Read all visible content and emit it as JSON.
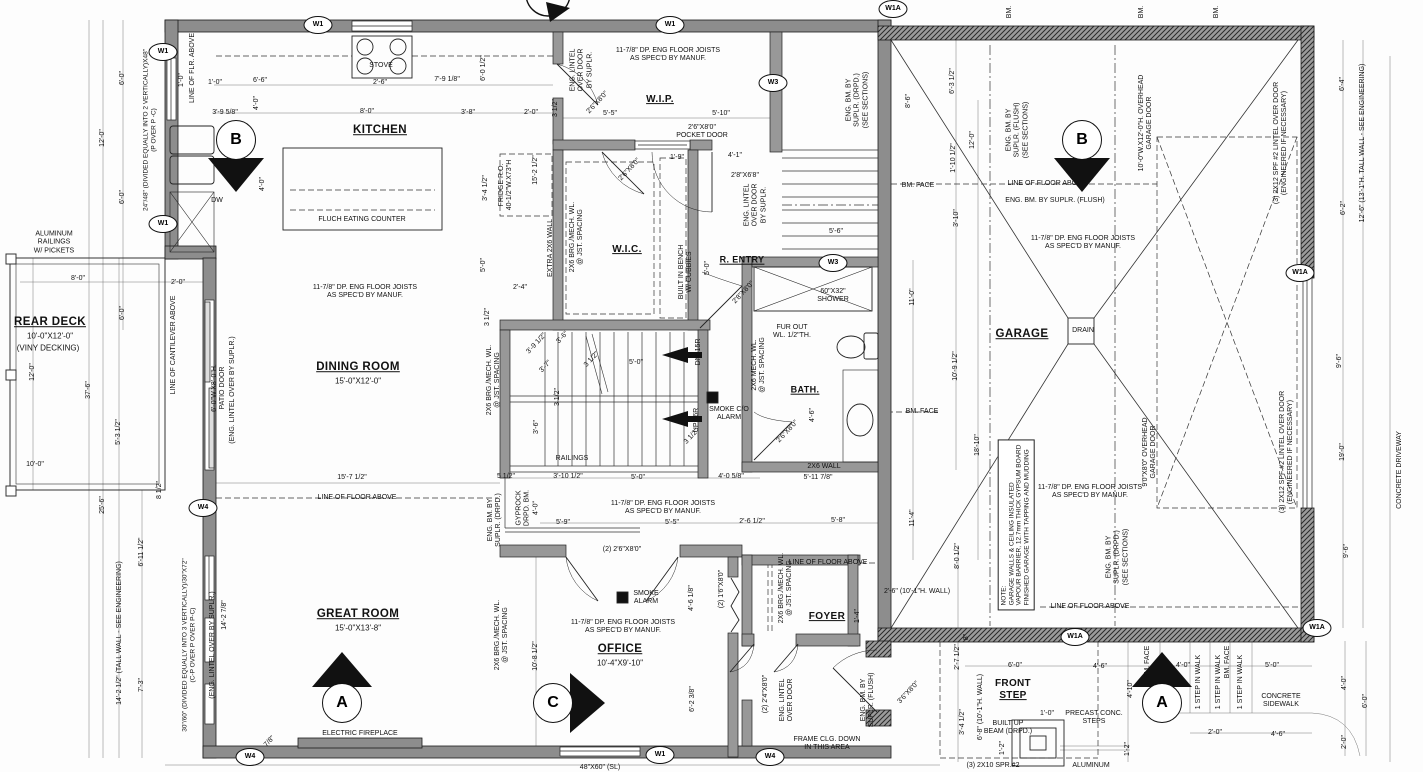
{
  "rooms": {
    "kitchen": "KITCHEN",
    "wip": "W.I.P.",
    "wic": "W.I.C.",
    "rentry": "R. ENTRY",
    "dining": {
      "name": "DINING ROOM",
      "size": "15'-0\"X12'-0\""
    },
    "bath": "BATH.",
    "garage": "GARAGE",
    "great": {
      "name": "GREAT ROOM",
      "size": "15'-0\"X13'-8\""
    },
    "office": {
      "name": "OFFICE",
      "size": "10'-4\"X9'-10\""
    },
    "foyer": "FOYER",
    "front_step": {
      "l1": "FRONT",
      "l2": "STEP"
    },
    "deck": {
      "name": "REAR DECK",
      "size": "10'-0\"X12'-0\"",
      "note": "(VINY DECKING)"
    }
  },
  "notes": {
    "joist": "11-7/8\" DP. ENG FLOOR JOISTS\nAS SPEC'D BY MANUF.",
    "lfa": "LINE OF FLOOR ABOVE",
    "lfra": "LINE OF FLR. ABOVE",
    "lca": "LINE OF CANTILEVER ABOVE",
    "bm": "BM.",
    "bmface": "BM. FACE",
    "ebfs": "ENG. BM. BY\nSUPLR. (FLUSH)\n(SEE SECTIONS)",
    "ebf": "ENG. BM. BY SUPLR. (FLUSH)",
    "ebds": "ENG. BM. BY\nSUPLR. (DRPD.)\n(SEE SECTIONS)",
    "ebd": "ENG. BM. BY\nSUPLR. (DRPD.)",
    "ebf2": "ENG. BM. BY\nSUPLR. (FLUSH)",
    "gyp": "GYPROCK\nDRPD. BM.\n4'-0\"",
    "eld": "ENG. LINTEL\nOVER DOOR\nBY SUPLR.",
    "eld2": "ENG. LINTEL\nOVER DOOR",
    "elo": "(ENG. LINTEL OVER BY SUPLR.)",
    "patio": "6'-0\"W.X8'-0\"H.\nPATIO DOOR",
    "w2448": "24\"/48\" (DIVIDED EQUALLY INTO 2 VERTICALLY)X48\"\n(P OVER P -C)",
    "w3060": "30\"/60\" (DIVIDED EQUALLY INTO 3 VERTICALLY)/30\"X72\"\n(C-P OVER P OVER P-C)",
    "twl": "14'-2 1/2\" (TALL WALL - SEE ENGINEERING)",
    "twr": "12'-6\" (13'-1\"H. TALL WALL - SEE ENGINEERING)",
    "gnote": "NOTE:\nGARAGE WALLS & CEILING INSULATED\nVAPOUR BARRIER, 12.7mm THICK GYPSUM BOARD\nFINISHED GARAGE WITH TAPPING AND MUDDING",
    "ohd1": "10'-0\"W.X12'-0\"H. OVERHEAD\nGARAGE DOOR",
    "ohd2": "9'0\"X8'0\" OVERHEAD\nGARAGE DOOR",
    "l2x12": "(3) 2X12 SPF #2 LINTEL OVER DOOR\n(ENGINEERED IF NECESSARY)",
    "brg": "2X6 BRG./MECH. WL.\n@ JST. SPACING",
    "mech": "2X6 MECH. WL.\n@ JST. SPACING",
    "extra": "EXTRA 2X6 WALL",
    "furout": "FUR OUT\nWL. 1/2\"TH.",
    "w2x6": "2X6 WALL",
    "frame": "FRAME CLG. DOWN\nIN THIS AREA",
    "bench": "BUILT IN BENCH\nW/ CUBBIES",
    "bub": "BUILT UP\nBEAM (DRPD.)",
    "precast": "PRECAST CONC.\nSTEPS",
    "spr": "(3) 2X10 SPR.#2",
    "alum": "ALUMINUM",
    "alrail": "ALUMINUM\nRAILINGS\nW/ PICKETS",
    "stepwalk": "1 STEP IN WALK",
    "sidewalk": "CONCRETE\nSIDEWALK",
    "driveway": "CONCRETE DRIVEWAY",
    "pocket": "2'6\"X8'0\"\nPOCKET DOOR",
    "railings": "RAILINGS",
    "dn": "DN. 15R",
    "up": "UP 16R"
  },
  "doors": {
    "d2680": "2'6\"X8'0\"",
    "d2880": "2'8\"X8'0\"",
    "d2868": "2'8\"X6'8\"",
    "d3680": "3'6\"X8'0\"",
    "french": "(2) 2'6\"X8'0\"",
    "bifold": "(2) 1'6\"X8'0\"",
    "dbl24": "(2) 2'4\"X8'0\"",
    "w4860": "48\"X60\" (SL)"
  },
  "fixtures": {
    "stove": "STOVE",
    "dw": "DW",
    "counter": "FLUCH EATING COUNTER",
    "fridge": "FRIDGE R.O.\n40-1/2\"W.X73\"H",
    "shower": "60\"X32\"\nSHOWER",
    "drain": "DRAIN",
    "smoke_co": "SMOKE C/O\nALARM",
    "smoke": "SMOKE\nALARM",
    "fireplace": "ELECTRIC FIREPLACE"
  },
  "dims": {
    "kitchen": [
      "1'-0\"",
      "6'-6\"",
      "2'-6\"",
      "7'-9 1/8\"",
      "6'-0 1/2\"",
      "3'-9 5/8\"",
      "8'-0\"",
      "3'-8\"",
      "2'-0\"",
      "3 1/2\"",
      "4'-0\"",
      "4'-0\"",
      "3'-4 1/2\"",
      "15'-2 1/2\"",
      "5'-0\""
    ],
    "wip": [
      "5'-5\"",
      "5'-10\"",
      "1'-9\"",
      "4'-1\"",
      "5'-0\"",
      "5'-6\""
    ],
    "left": [
      "6'-0\"",
      "12'-0\"",
      "6'-0\"",
      "1'-0\"",
      "8'-0\"",
      "2'-0\"",
      "6'-0\"",
      "12'-0\"",
      "37'-6\"",
      "10'-0\"",
      "5'-3 1/2\"",
      "25'-6\"",
      "8 1/2\"",
      "6'-11 1/2\"",
      "7'-3\"",
      "14'-2 7/8\""
    ],
    "stairs": [
      "2'-4\"",
      "3 1/2\"",
      "3'-9 1/2\"",
      "3'-6\"",
      "3'-7\"",
      "3 1/2\"",
      "5'-0\"",
      "3 1/2\"",
      "3'-6\"",
      "3 1/2\"",
      "3'-10 1/2\"",
      "5'-0\"",
      "4'-0 5/8\"",
      "5 1/2\"",
      "15'-7 1/2\""
    ],
    "bath": [
      "4'-6\"",
      "5'-11 7/8\"",
      "11'-0\"",
      "10'-9 1/2\"",
      "18'-10\"",
      "11'-4\""
    ],
    "garage": [
      "8'-6\"",
      "6'-3 1/2\"",
      "12'-0\"",
      "1'-10 1/2\"",
      "3'-10\"",
      "6'-4\"",
      "6'-2\"",
      "9'-6\"",
      "19'-0\"",
      "9'-6\""
    ],
    "office": [
      "5'-9\"",
      "5'-5\"",
      "2'-6 1/2\"",
      "5'-8\"",
      "10'-8 1/2\"",
      "4'-6 1/8\"",
      "6'-2 3/8\"",
      "7/8\""
    ],
    "front": [
      "8'-0 1/2\"",
      "2'-6\" (10'-1\"H. WALL)",
      "1'-4\"",
      "8\"",
      "2'-7 1/2\"",
      "3'-4 1/2\"",
      "6'-8\" (10'-1\"H. WALL)",
      "6'-0\"",
      "4'-6\"",
      "1'-0\"",
      "1'-2\"",
      "1'-2\"",
      "4'-10\"",
      "4'-0\"",
      "5'-0\"",
      "2'-0\"",
      "4'-6\"",
      "4'-0\"",
      "6'-0\"",
      "2'-0\""
    ]
  },
  "markers": {
    "a": "A",
    "b": "B",
    "c": "C",
    "w1": "W1",
    "w1a": "W1A",
    "w3": "W3",
    "w4": "W4"
  }
}
